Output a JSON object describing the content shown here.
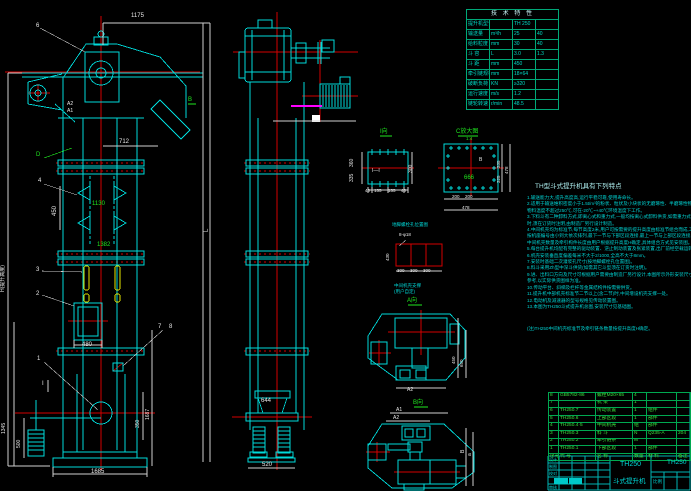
{
  "sheet": {
    "type": "CAD assembly drawing",
    "product": "TH250 bucket elevator"
  },
  "labels": {
    "dim_1175": "1175",
    "balloon_6": "6",
    "dim_a2": "A2",
    "dim_a1": "A1",
    "view_b": "B",
    "balloon_d": "D",
    "dim_712": "712",
    "balloon_4": "4",
    "dim_450": "450",
    "dim_1130": "1130",
    "dim_1382": "1382",
    "balloon_3": "3",
    "balloon_2": "2",
    "dim_480": "480",
    "balloon_7": "7",
    "balloon_8": "8",
    "balloon_1": "1",
    "section_i": "I",
    "dim_1345": "1345",
    "dim_500": "500",
    "dim_1685": "1685",
    "dim_h": "H(提升高度)",
    "dim_l": "L",
    "dim_1687": "1687",
    "dim_350": "350",
    "dim_644": "644",
    "dim_520": "520",
    "view_i": "I向",
    "mark_ii": "I—I",
    "dim_360": "360",
    "dim_335": "335",
    "dim_300": "300",
    "seg_40a": "40",
    "seg_155a": "155",
    "seg_155b": "155",
    "seg_40b": "40",
    "view_c": "C放大图",
    "scale_c": "1:4",
    "dim_666": "666",
    "mark_b": "B",
    "dim_200a": "200",
    "dim_200b": "200",
    "dim_478": "478",
    "dim_335r": "335",
    "dim_325r": "325",
    "dim_478r": "478",
    "anchor_title": "地脚螺栓孔位置图",
    "anchor_bolts": "8-φ18",
    "dim_430": "430",
    "dim_300a": "300",
    "dim_300b": "300",
    "dim_300c": "300",
    "support_note1": "中间机壳支撑",
    "support_note2": "(用户自定)",
    "view_a": "A向",
    "dim_a2b": "A2",
    "dim_450r": "450",
    "dim_650r": "650",
    "view_b2": "B向",
    "dim_a1b": "A1",
    "dim_a2c": "A2",
    "dim_bb": "B",
    "dim_aa": "a"
  },
  "tech_table": {
    "title": "技 术 特 性",
    "rows": [
      {
        "label": "提升机型号",
        "unit": "",
        "v1": "TH 250",
        "v2": ""
      },
      {
        "label": "输送量",
        "unit": "m³/h",
        "v1": "25",
        "v2": "40"
      },
      {
        "label": "给料粒度",
        "unit": "mm",
        "v1": "30",
        "v2": "40"
      },
      {
        "label": "斗 容",
        "unit": "L",
        "v1": "3.0",
        "v2": "1.3"
      },
      {
        "label": "斗 距",
        "unit": "mm",
        "v1": "450",
        "v2": ""
      },
      {
        "label": "牵引链规格",
        "unit": "mm",
        "v1": "18×64",
        "v2": ""
      },
      {
        "label": "破断负荷",
        "unit": "KN",
        "v1": "≥320",
        "v2": ""
      },
      {
        "label": "运行速度",
        "unit": "m/s",
        "v1": "1.2",
        "v2": ""
      },
      {
        "label": "链轮转速",
        "unit": "r/min",
        "v1": "48.5",
        "v2": ""
      }
    ]
  },
  "notes": {
    "title": "TH型斗式提升机具有下列特点",
    "lines": [
      "1.输送能力大,提升高度高,运行平稳可靠,使用寿命长。",
      "2.适用于输送堆积密度小于1.5t/m³的粉状、粒状及小块状的无磨琢性、半磨琢性物料,",
      "   物料温度不超过250℃,可在-20℃~+40℃环境温度下工作。",
      "3.下料斗有二种卸料方式,即离心式和重力式,一般均按离心式卸料供货,如需重力式卸料",
      "   时,须在订货时注明,由制造厂另行设计制造。",
      "4.中间机壳均为标准节,每节高度2米,用户可按需要的提升高度由标准节组合而成,工况",
      "   按机座编号由小到大依次排列,最下一节与下部区段连接,最上一节与上部区段连接,",
      "   中间机壳数量及牵引构件长度由用户根据提升高度H确定,具体组合方式见安装图。",
      "5.每台提升机均配有完整的驱动装置、逆止制动装置及张紧装置,出厂前经空载运转试验。",
      "6.机壳安装垂直度偏差每米不大于2/1000,全高不大于8mm。",
      "7.安装时基础二次灌浆孔尺寸(按地脚螺栓孔位置图)。",
      "8.料斗采用Zh型中深斗供货(如需其它斗型须在订货时注明)。",
      "9.进、出料口方向及尺寸可根据用户需要由制造厂另行设计,本图所示外形安装尺寸仅供",
      "   参考,以实际供货图样为准。",
      "10.传动平台、斜梯及栏杆等金属结构件按需要供货。",
      "11.提升机中部机壳标准节二节以上(含二节)时,中间增设机壳支撑一处。",
      "12.电动机及减速器的型号规格见传动装置图。",
      "13.本图为TH250斗式提升机总图,安装尺寸见基础图。"
    ],
    "foot": "(注)TH250中间机壳标准节及牵引链条数量按提升高度H确定。"
  },
  "bom": {
    "headers": [
      "序号",
      "代 号",
      "名 称",
      "数量",
      "材 料",
      "备注"
    ],
    "rows": [
      [
        "8",
        "GB5782-86",
        "螺栓M20×65",
        "4",
        "",
        ""
      ],
      [
        "7",
        "",
        "机 架",
        "1",
        "",
        ""
      ],
      [
        "6",
        "TH250.7",
        "传动装置",
        "1",
        "组件",
        ""
      ],
      [
        "5",
        "TH250.6",
        "上部区段",
        "1",
        "部件",
        ""
      ],
      [
        "4",
        "TH250.4·5",
        "中间机壳",
        "组",
        "部件",
        ""
      ],
      [
        "3",
        "TH250.3",
        "料 斗",
        "N",
        "Q235-A",
        "204"
      ],
      [
        "2",
        "TH250.2",
        "牵引链条",
        "M",
        "",
        ""
      ],
      [
        "1",
        "TH250.1",
        "下部区段",
        "1",
        "部件",
        ""
      ]
    ]
  },
  "title_block": {
    "model": "TH250",
    "product": "斗式提升机",
    "drawing_no": "TH250",
    "scale_label": "比例",
    "rows": [
      "设计",
      "制图",
      "校对",
      "审核"
    ]
  }
}
